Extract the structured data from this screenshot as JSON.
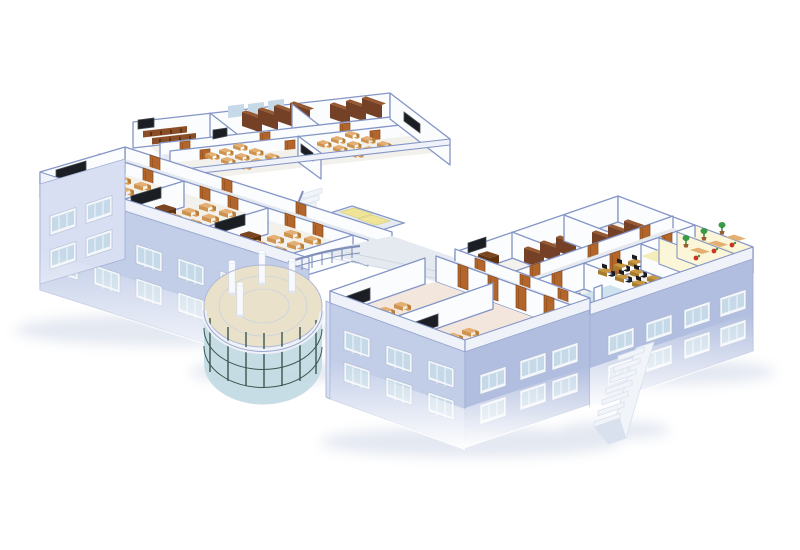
{
  "scene": {
    "kind": "architectural-3d-cutaway",
    "subject": "Isometric cutaway rendering of a school building floor: classrooms with desks and blackboards, library stacks, lecture room, computer lab, art rooms, washrooms, elevator lobby with stairs, bridge corridor, glass rotunda atrium and an external staircase",
    "background": "#ffffff",
    "areas": [
      "north-wing",
      "west-wing-classrooms",
      "lecture-room",
      "library-stacks",
      "elevator-lobby",
      "bridge-corridor",
      "rotunda-atrium",
      "southeast-block",
      "computer-lab",
      "art-rooms",
      "washrooms",
      "south-wing-classrooms",
      "external-staircase"
    ]
  },
  "colors": {
    "page_bg": "#ffffff",
    "wall_top_edge": "#8495c6",
    "int_wall": "#fbfcfe",
    "wall_yellow": "#fbf6d8",
    "slab": "#eff2f9",
    "ext_wall": "#c2cde8",
    "ext_wall_dark": "#b1bedf",
    "ext_wall_light": "#d8dff2",
    "ext_edge": "#9fadd2",
    "floor_room": "#f3f1ec",
    "floor_room_warm": "#f3e7dd",
    "floor_corridor": "#e4eaf0",
    "floor_bath": "#cfe3ef",
    "floor_yellow": "#f4edba",
    "floor_lobby": "#eae1cb",
    "floor_tile_line": "#c9d3de",
    "window_frame": "#f3f6fa",
    "window_glass": "#c6d9e8",
    "glass": "#c3dae3",
    "mullion": "#3a574e",
    "door": "#b2662c",
    "door_dark": "#8c4a1b",
    "board": "#1b1e23",
    "board_frame": "#474c55",
    "desk": "#e4af72",
    "desk_side": "#cf9350",
    "chair": "#d99c4e",
    "chair_dark": "#b97f39",
    "teacher_desk": "#7b4520",
    "teacher_desk_dark": "#5f330f",
    "shelf": "#744026",
    "shelf_top": "#96582f",
    "seat_row": "#8a4e27",
    "lab_desk": "#c9973f",
    "lab_dark": "#1a1c1f",
    "plant": "#3a9a4a",
    "flower_red": "#cc3322",
    "mat_yellow": "#efe498",
    "elevator_door": "#16181d",
    "stair": "#f1f4f9",
    "stair_shade": "#d9e1ee",
    "railing": "#7f8fb8",
    "shadow": "#aebcd6"
  }
}
